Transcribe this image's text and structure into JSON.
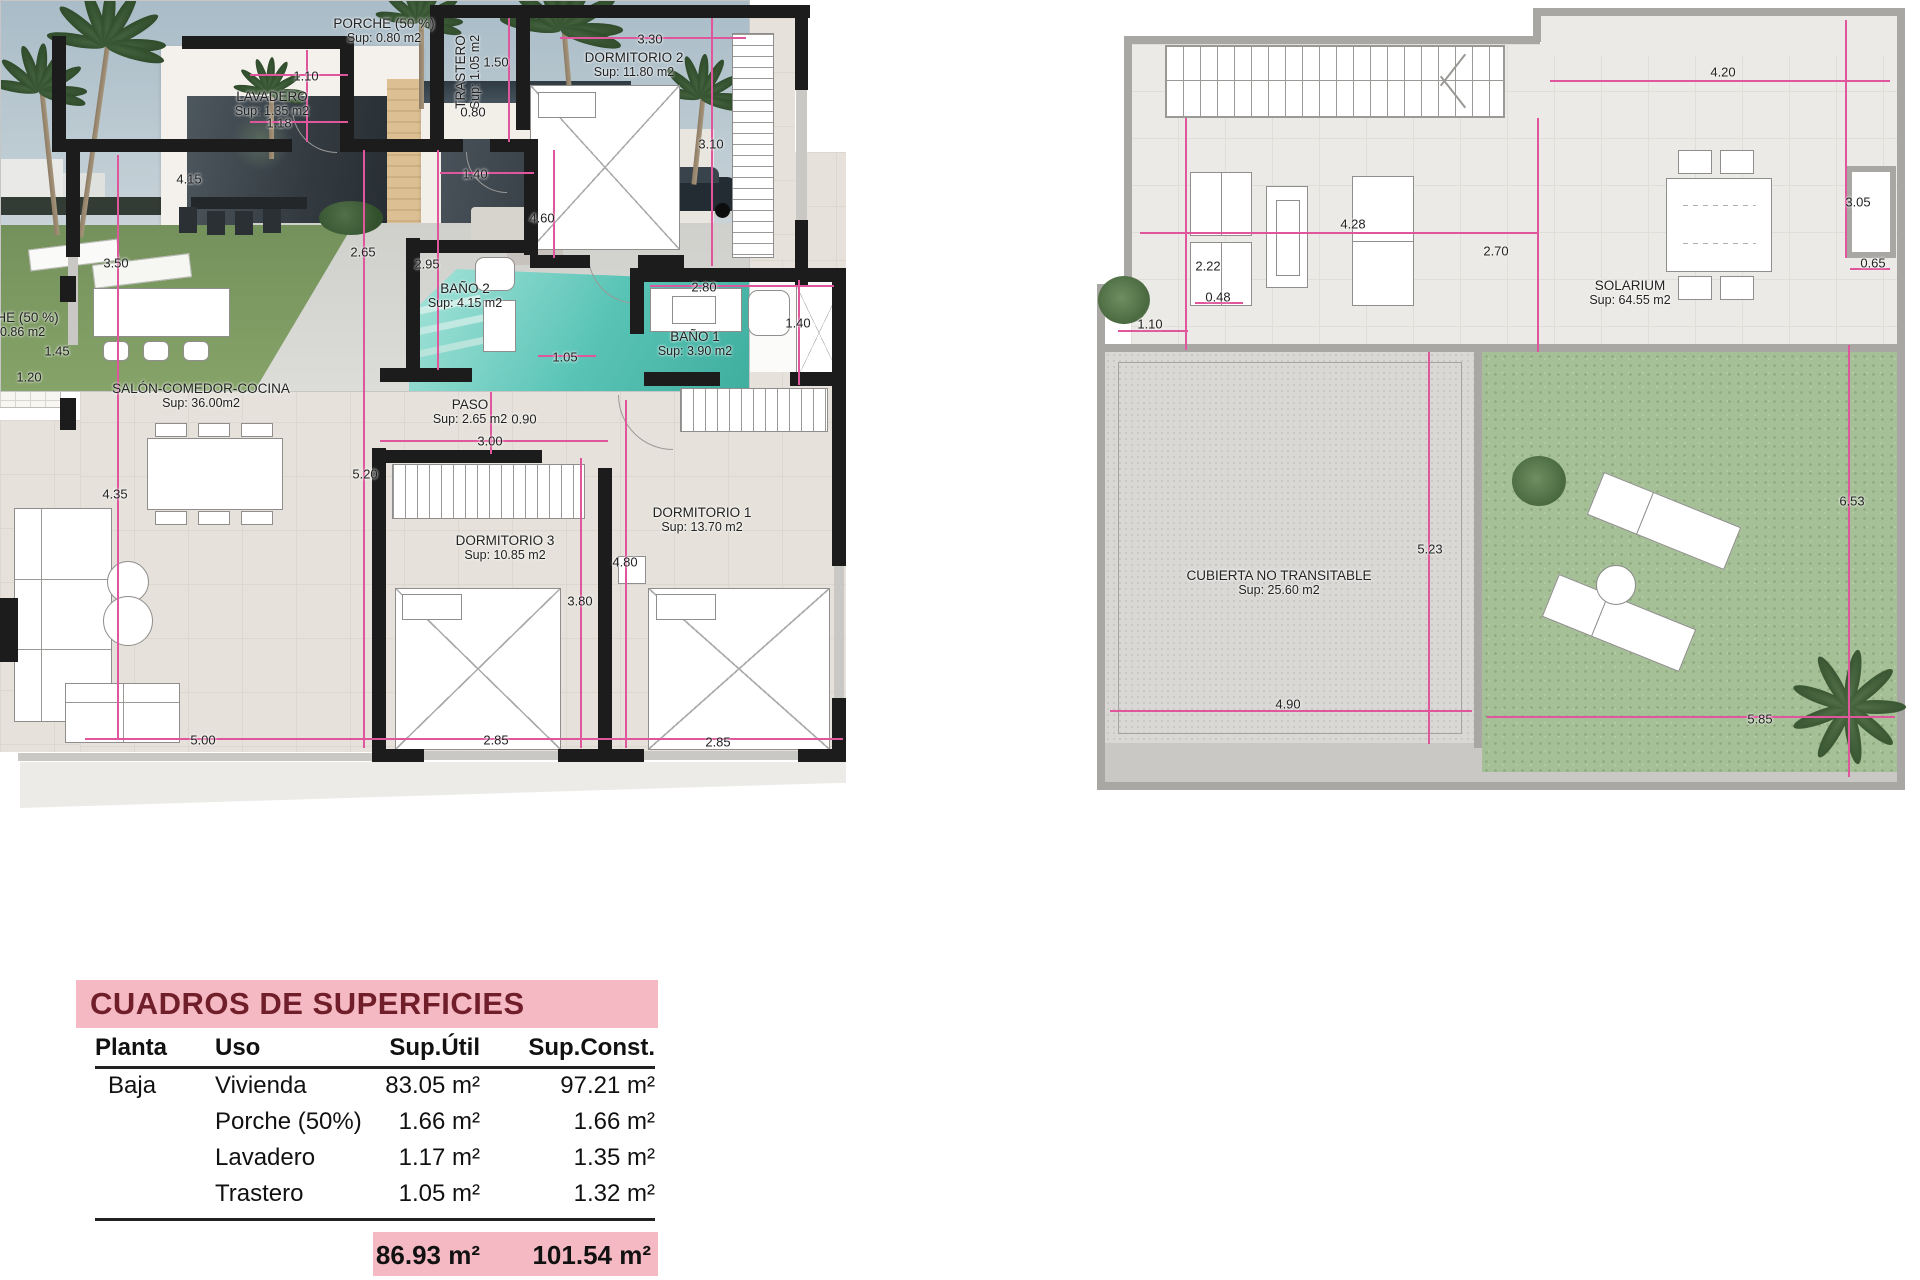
{
  "sheet": {
    "type": "floor-plan-sheet",
    "plans": [
      "planta-baja",
      "cubierta-solarium"
    ]
  },
  "left_plan": {
    "rooms": [
      {
        "name": "PORCHE (50 %)",
        "sup": "Sup: 0.80 m2",
        "x": 384,
        "y": 31
      },
      {
        "name": "LAVADERO",
        "sup": "Sup: 1.35 m2",
        "x": 272,
        "y": 104
      },
      {
        "name": "TRASTERO",
        "sup": "Sup: 1.05 m2",
        "x": 468,
        "y": 72,
        "vert": true
      },
      {
        "name": "DORMITORIO 2",
        "sup": "Sup: 11.80 m2",
        "x": 634,
        "y": 65
      },
      {
        "name": "BAÑO 2",
        "sup": "Sup: 4.15 m2",
        "x": 465,
        "y": 296
      },
      {
        "name": "BAÑO 1",
        "sup": "Sup: 3.90 m2",
        "x": 695,
        "y": 344
      },
      {
        "name": "PASO",
        "sup": "Sup: 2.65 m2",
        "x": 470,
        "y": 412
      },
      {
        "name": "SALÓN-COMEDOR-COCINA",
        "sup": "Sup: 36.00m2",
        "x": 201,
        "y": 396
      },
      {
        "name": "DORMITORIO 3",
        "sup": "Sup: 10.85 m2",
        "x": 505,
        "y": 548
      },
      {
        "name": "DORMITORIO 1",
        "sup": "Sup: 13.70 m2",
        "x": 702,
        "y": 520
      },
      {
        "name": "PORCHE (50 %)",
        "sup": "Sup: 0.86 m2",
        "x": 8,
        "y": 325
      }
    ],
    "dims": [
      {
        "t": "1.10",
        "x": 306,
        "y": 76
      },
      {
        "t": "1.18",
        "x": 279,
        "y": 123
      },
      {
        "t": "1.50",
        "x": 496,
        "y": 62
      },
      {
        "t": "0.80",
        "x": 473,
        "y": 112
      },
      {
        "t": "3.30",
        "x": 650,
        "y": 39
      },
      {
        "t": "3.10",
        "x": 711,
        "y": 144
      },
      {
        "t": "1.40",
        "x": 475,
        "y": 174
      },
      {
        "t": "4.60",
        "x": 542,
        "y": 218
      },
      {
        "t": "4.15",
        "x": 189,
        "y": 179
      },
      {
        "t": "2.65",
        "x": 363,
        "y": 252
      },
      {
        "t": "2.95",
        "x": 427,
        "y": 264
      },
      {
        "t": "3.50",
        "x": 116,
        "y": 263
      },
      {
        "t": "2.80",
        "x": 704,
        "y": 287
      },
      {
        "t": "1.40",
        "x": 798,
        "y": 323
      },
      {
        "t": "1.05",
        "x": 565,
        "y": 357
      },
      {
        "t": "0.90",
        "x": 524,
        "y": 419
      },
      {
        "t": "3.00",
        "x": 490,
        "y": 441
      },
      {
        "t": "1.45",
        "x": 57,
        "y": 351
      },
      {
        "t": "1.20",
        "x": 29,
        "y": 377
      },
      {
        "t": "4.35",
        "x": 115,
        "y": 494
      },
      {
        "t": "5.20",
        "x": 365,
        "y": 474
      },
      {
        "t": "4.80",
        "x": 625,
        "y": 562
      },
      {
        "t": "3.80",
        "x": 580,
        "y": 601
      },
      {
        "t": "5.00",
        "x": 203,
        "y": 740
      },
      {
        "t": "2.85",
        "x": 496,
        "y": 740
      },
      {
        "t": "2.85",
        "x": 718,
        "y": 742
      }
    ]
  },
  "right_plan": {
    "rooms": [
      {
        "name": "SOLARIUM",
        "sup": "Sup: 64.55 m2",
        "x": 1630,
        "y": 293
      },
      {
        "name": "CUBIERTA NO TRANSITABLE",
        "sup": "Sup: 25.60 m2",
        "x": 1279,
        "y": 583
      }
    ],
    "dims": [
      {
        "t": "4.20",
        "x": 1723,
        "y": 72
      },
      {
        "t": "3.05",
        "x": 1858,
        "y": 202
      },
      {
        "t": "4.28",
        "x": 1353,
        "y": 224
      },
      {
        "t": "2.22",
        "x": 1208,
        "y": 266
      },
      {
        "t": "2.70",
        "x": 1496,
        "y": 251
      },
      {
        "t": "0.48",
        "x": 1218,
        "y": 297
      },
      {
        "t": "1.10",
        "x": 1150,
        "y": 324
      },
      {
        "t": "0.65",
        "x": 1873,
        "y": 263
      },
      {
        "t": "5.23",
        "x": 1430,
        "y": 549
      },
      {
        "t": "4.90",
        "x": 1288,
        "y": 704
      },
      {
        "t": "6.53",
        "x": 1852,
        "y": 501
      },
      {
        "t": "5.85",
        "x": 1760,
        "y": 719
      }
    ]
  },
  "table": {
    "title": "CUADROS DE SUPERFICIES",
    "columns": [
      "Planta",
      "Uso",
      "Sup.Útil",
      "Sup.Const."
    ],
    "rows": [
      {
        "planta": "Baja",
        "uso": "Vivienda",
        "util": "83.05 m²",
        "const": "97.21 m²"
      },
      {
        "planta": "",
        "uso": "Porche (50%)",
        "util": "1.66 m²",
        "const": "1.66 m²"
      },
      {
        "planta": "",
        "uso": "Lavadero",
        "util": "1.17 m²",
        "const": "1.35 m²"
      },
      {
        "planta": "",
        "uso": "Trastero",
        "util": "1.05 m²",
        "const": "1.32 m²"
      }
    ],
    "totals": {
      "util": "86.93 m²",
      "const": "101.54 m²"
    }
  },
  "colors": {
    "dimension_pink": "#e0569c",
    "wall_black": "#1c1c1c",
    "floor_beige": "#e6e2db",
    "grass_green": "#a5bf96",
    "table_pink": "#f5b9c3",
    "table_title_maroon": "#701f2a",
    "pool_teal": "#4db8ac"
  }
}
